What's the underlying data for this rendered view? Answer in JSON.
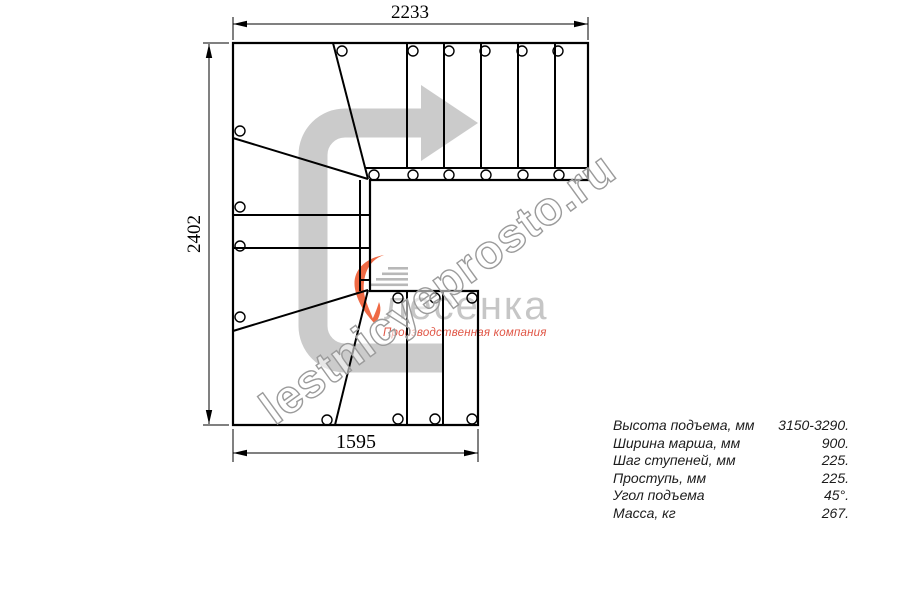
{
  "drawing": {
    "title": "staircase-plan-view",
    "dim_top": "2233",
    "dim_left": "2402",
    "dim_bottom": "1595"
  },
  "logo": {
    "name": "лесенка",
    "tagline": "Производственная компания",
    "accent_color": "#ef6a45",
    "text_color": "#c6c6c6"
  },
  "watermark": {
    "text": "lestnicyeprosto.ru"
  },
  "arrow": {
    "meaning": "direction of travel",
    "color": "#cbcbcb"
  },
  "specs": {
    "rows": [
      {
        "label": "Высота подъема, мм",
        "value": "3150-3290."
      },
      {
        "label": "Ширина марша, мм",
        "value": "900."
      },
      {
        "label": "Шаг ступеней, мм",
        "value": "225."
      },
      {
        "label": "Проступь, мм",
        "value": "225."
      },
      {
        "label": "Угол подъема",
        "value": "45°."
      },
      {
        "label": "Масса, кг",
        "value": "267."
      }
    ]
  }
}
